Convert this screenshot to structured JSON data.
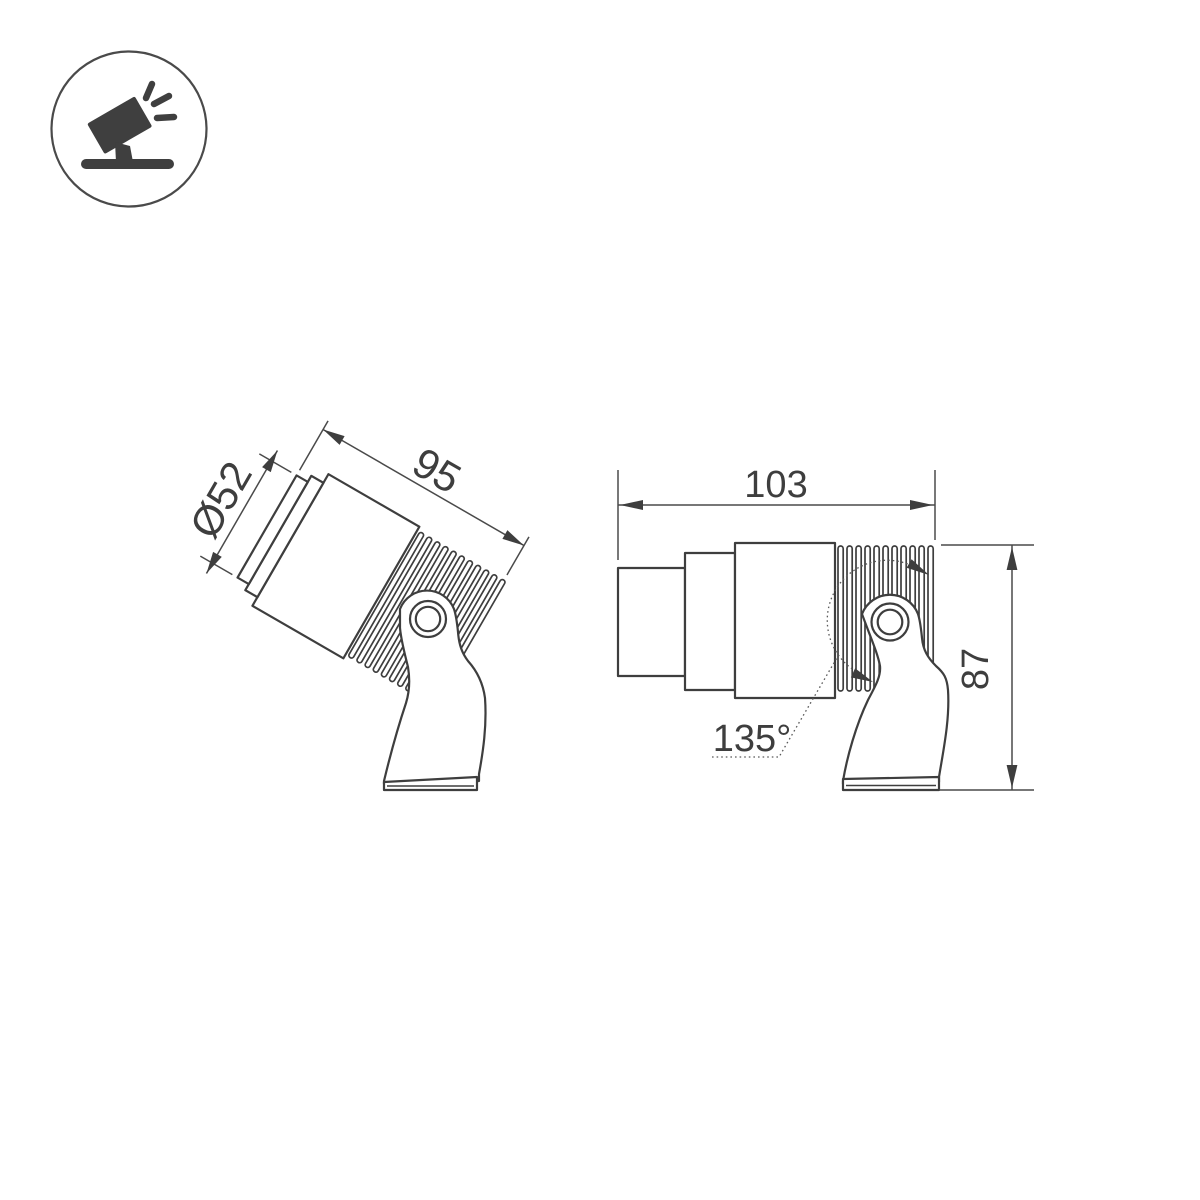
{
  "canvas": {
    "background": "#ffffff",
    "line_color": "#3e3e3e"
  },
  "logo": {
    "icon": "spotlight-icon"
  },
  "views": {
    "tilted": {
      "name": "tilted-view",
      "dims": {
        "diameter": "Ø52",
        "length": "95"
      }
    },
    "side": {
      "name": "side-view",
      "dims": {
        "length": "103",
        "height": "87",
        "angle": "135°"
      }
    }
  }
}
